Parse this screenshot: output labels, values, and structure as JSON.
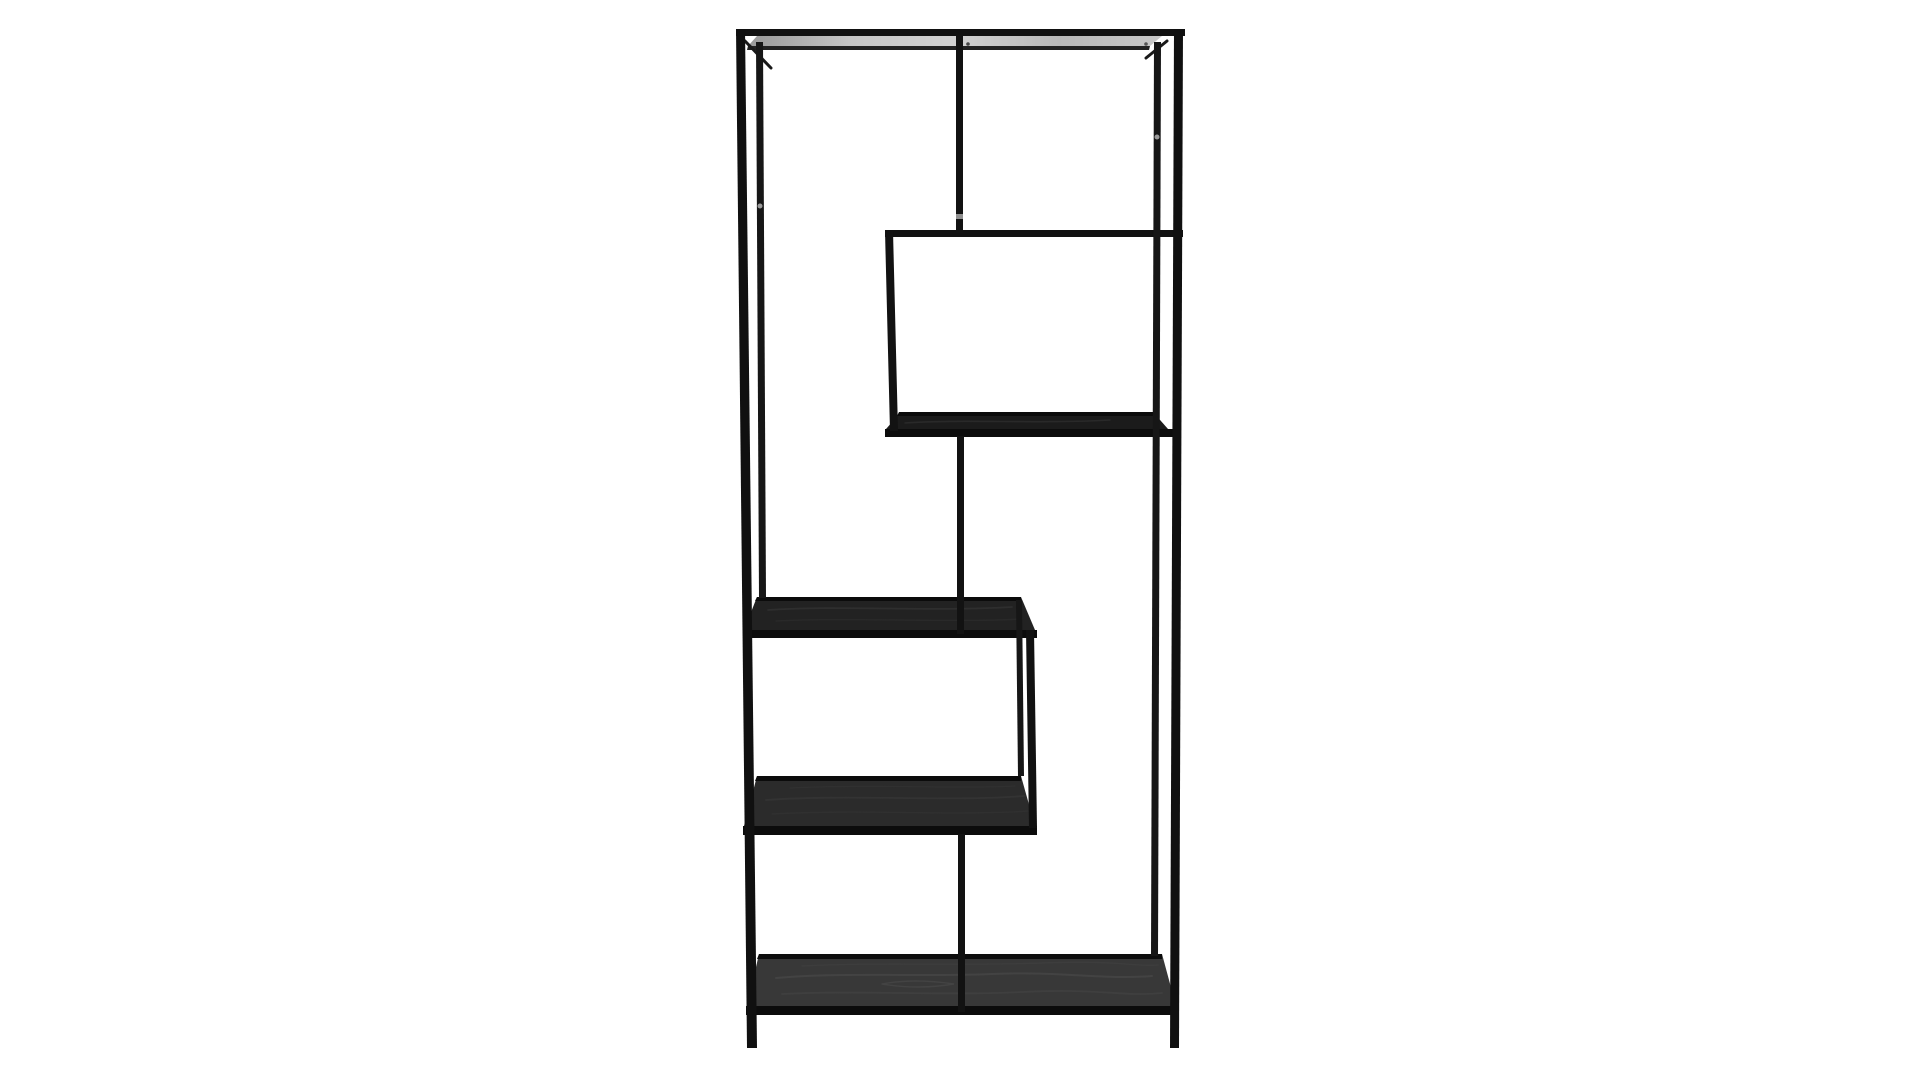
{
  "meta": {
    "description": "Product photo of a tall black metal etagere bookcase with asymmetric zig-zag shelves on a white background",
    "visible_text": ""
  },
  "scene": {
    "background": "#ffffff",
    "canvas_width": 1920,
    "canvas_height": 1080
  },
  "palette": {
    "frame": "#111111",
    "frame_soft": "#161616",
    "frame_dark": "#0b0b0b",
    "panel_dark": "#1b1b1b",
    "panel_mid": "#222222",
    "panel_lower": "#2b2b2b",
    "panel_bottom": "#383838",
    "top_surface": "url(#topStripGrad)",
    "screw": "#9a9a9a"
  },
  "shapes": [
    {
      "name": "box-bottom-panel",
      "type": "polygon",
      "pts": "886,429 901,412 1153,412 1168,429",
      "fill": "#1b1b1b"
    },
    {
      "name": "box-bottom-grain",
      "type": "path",
      "d": "M905,423 C960,419 1040,424 1110,420",
      "stroke": "#2f2f2f",
      "sw": 1.6,
      "opacity": 0.7
    },
    {
      "name": "box-bottom-back-bar",
      "type": "polygon",
      "pts": "899,412 1153,412 1153,416 897,416",
      "fill": "#0b0b0b"
    },
    {
      "name": "box-bottom-front-bar",
      "type": "rect",
      "x": 885,
      "y": 429,
      "w": 290,
      "h": 8,
      "fill": "#0c0c0c"
    },
    {
      "name": "middle-shelf-panel",
      "type": "polygon",
      "pts": "744,630 757,597 1021,597 1035,630",
      "fill": "#222222"
    },
    {
      "name": "middle-shelf-grain-1",
      "type": "path",
      "d": "M768,610 C840,605 930,612 1012,607",
      "stroke": "#333333",
      "sw": 1.8,
      "opacity": 0.7
    },
    {
      "name": "middle-shelf-grain-2",
      "type": "path",
      "d": "M776,621 C855,617 945,623 1022,619",
      "stroke": "#2e2e2e",
      "sw": 1.4,
      "opacity": 0.6
    },
    {
      "name": "middle-shelf-back-bar",
      "type": "polygon",
      "pts": "757,597 1021,597 1021,601 755,601",
      "fill": "#0b0b0b"
    },
    {
      "name": "middle-shelf-front-bar",
      "type": "rect",
      "x": 743,
      "y": 630,
      "w": 294,
      "h": 8,
      "fill": "#0c0c0c"
    },
    {
      "name": "lower-shelf-panel",
      "type": "polygon",
      "pts": "744,826 757,776 1021,776 1035,826",
      "fill": "#2b2b2b"
    },
    {
      "name": "lower-shelf-grain-1",
      "type": "path",
      "d": "M766,800 C850,794 950,802 1024,796",
      "stroke": "#383838",
      "sw": 1.8,
      "opacity": 0.7
    },
    {
      "name": "lower-shelf-grain-2",
      "type": "path",
      "d": "M772,814 C860,809 960,816 1028,811",
      "stroke": "#343434",
      "sw": 1.4,
      "opacity": 0.6
    },
    {
      "name": "lower-shelf-grain-3",
      "type": "path",
      "d": "M790,788 C870,784 970,789 1015,786",
      "stroke": "#363636",
      "sw": 1.2,
      "opacity": 0.5
    },
    {
      "name": "lower-shelf-back-bar",
      "type": "polygon",
      "pts": "757,776 1021,776 1021,781 755,781",
      "fill": "#0b0b0b"
    },
    {
      "name": "lower-shelf-front-bar",
      "type": "rect",
      "x": 743,
      "y": 826,
      "w": 294,
      "h": 9,
      "fill": "#0c0c0c"
    },
    {
      "name": "bottom-shelf-panel",
      "type": "polygon",
      "pts": "747,1006 759,954 1162,954 1176,1006",
      "fill": "#383838"
    },
    {
      "name": "bottom-shelf-grain-1",
      "type": "path",
      "d": "M776,978 C842,972 922,977 992,974 S1102,980 1152,976",
      "stroke": "#4b4b4b",
      "sw": 2,
      "opacity": 0.6
    },
    {
      "name": "bottom-shelf-grain-2",
      "type": "path",
      "d": "M782,994 C862,990 942,996 1022,992 S1122,997 1162,993",
      "stroke": "#454545",
      "sw": 1.8,
      "opacity": 0.55
    },
    {
      "name": "bottom-shelf-grain-3",
      "type": "path",
      "d": "M802,966 C882,962 962,966 1042,963 S1132,967 1158,965",
      "stroke": "#424242",
      "sw": 1.4,
      "opacity": 0.5
    },
    {
      "name": "bottom-shelf-grain-knot",
      "type": "path",
      "d": "M882,984 q32,-6 72,0 q-36,6 -72,0",
      "stroke": "#4e4e4e",
      "sw": 1.4,
      "opacity": 0.5
    },
    {
      "name": "bottom-shelf-back-bar",
      "type": "polygon",
      "pts": "759,954 1162,954 1162,959 757,959",
      "fill": "#0d0d0d"
    },
    {
      "name": "bottom-shelf-front-bar",
      "type": "rect",
      "x": 746,
      "y": 1006,
      "w": 431,
      "h": 9,
      "fill": "#0c0c0c"
    },
    {
      "name": "top-bar",
      "type": "rect",
      "x": 736,
      "y": 29,
      "w": 449,
      "h": 7,
      "fill": "#111111"
    },
    {
      "name": "top-surface-strip",
      "type": "polygon",
      "pts": "757,36 1162,36 1150,46 748,46",
      "fill": "url(#topStripGrad)"
    },
    {
      "name": "top-back-bar",
      "type": "polygon",
      "pts": "748,46 1150,46 1149,50 747,50",
      "fill": "#222222"
    },
    {
      "name": "box-top-bar",
      "type": "rect",
      "x": 885,
      "y": 230,
      "w": 298,
      "h": 7,
      "fill": "#111111"
    },
    {
      "name": "left-corner-brace",
      "type": "line",
      "x1": 745,
      "y1": 41,
      "x2": 771,
      "y2": 68,
      "stroke": "#191919",
      "sw": 3
    },
    {
      "name": "right-corner-brace",
      "type": "line",
      "x1": 1167,
      "y1": 41,
      "x2": 1146,
      "y2": 58,
      "stroke": "#191919",
      "sw": 3
    },
    {
      "name": "back-left-post",
      "type": "polygon",
      "pts": "756,42 763,42 766,598 759,598",
      "fill": "#161616"
    },
    {
      "name": "back-right-post",
      "type": "polygon",
      "pts": "1154,42 1161,42 1158,956 1151,956",
      "fill": "#161616"
    },
    {
      "name": "top-divider",
      "type": "rect",
      "x": 956,
      "y": 35,
      "w": 7,
      "h": 198,
      "fill": "#121212"
    },
    {
      "name": "box-left-member",
      "type": "polygon",
      "pts": "885,231 893,231 898,431 890,431",
      "fill": "#121212"
    },
    {
      "name": "mid-divider",
      "type": "rect",
      "x": 957,
      "y": 436,
      "w": 7,
      "h": 198,
      "fill": "#121212"
    },
    {
      "name": "lower-box-right-back",
      "type": "polygon",
      "pts": "1016,600 1022,600 1024,776 1018,776",
      "fill": "#161616"
    },
    {
      "name": "lower-box-right-front",
      "type": "polygon",
      "pts": "1026,630 1034,630 1037,828 1029,828",
      "fill": "#111111"
    },
    {
      "name": "bottom-divider",
      "type": "rect",
      "x": 958,
      "y": 834,
      "w": 7,
      "h": 178,
      "fill": "#121212"
    },
    {
      "name": "front-left-post",
      "type": "polygon",
      "pts": "736,29 745,29 757,1048 747,1048",
      "fill": "#101010"
    },
    {
      "name": "front-right-post",
      "type": "polygon",
      "pts": "1174,29 1183,29 1179,1048 1170,1048",
      "fill": "#101010"
    },
    {
      "name": "screw-left-post",
      "type": "circle",
      "cx": 760,
      "cy": 206,
      "r": 2.5,
      "fill": "#9a9a9a"
    },
    {
      "name": "screw-right-post",
      "type": "circle",
      "cx": 1157,
      "cy": 137,
      "r": 2.5,
      "fill": "#9a9a9a"
    },
    {
      "name": "divider-joint-notch",
      "type": "rect",
      "x": 956,
      "y": 214,
      "w": 7,
      "h": 5,
      "fill": "#8f8f8f"
    },
    {
      "name": "screw-under-top-1",
      "type": "circle",
      "cx": 968,
      "cy": 44,
      "r": 1.8,
      "fill": "#444444"
    },
    {
      "name": "screw-under-top-2",
      "type": "circle",
      "cx": 1146,
      "cy": 44,
      "r": 1.8,
      "fill": "#555555"
    }
  ]
}
